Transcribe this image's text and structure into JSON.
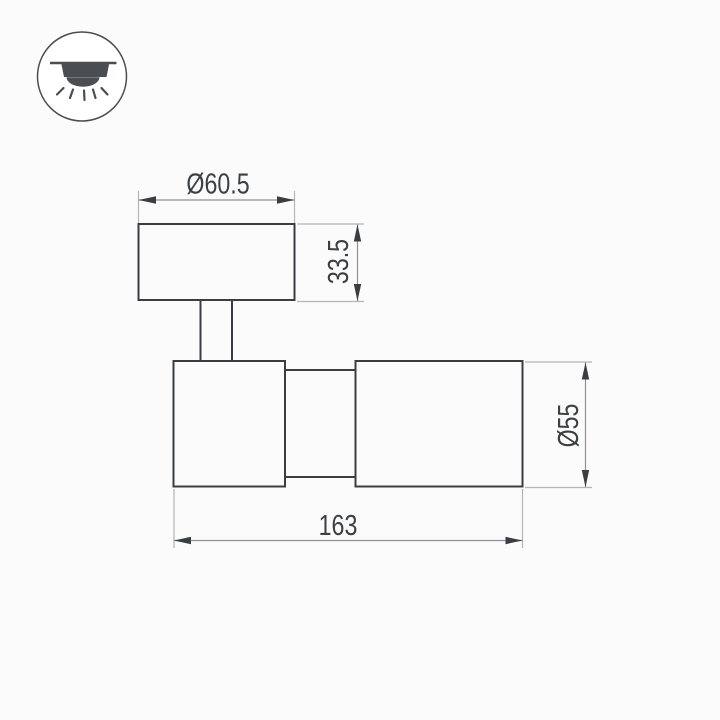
{
  "icon_legend": {
    "name": "ceiling-downlight-icon"
  },
  "dimensions": {
    "top_diameter": "Ø60.5",
    "base_height": "33.5",
    "body_diameter": "Ø55",
    "total_length": "163"
  },
  "colors": {
    "object_line": "#3a3e42",
    "dimension_line": "#8e9194",
    "extension_line": "#b3b5b7",
    "label_text": "#3c4043",
    "icon": "#4a4e52",
    "background": "#fbfbfb"
  }
}
